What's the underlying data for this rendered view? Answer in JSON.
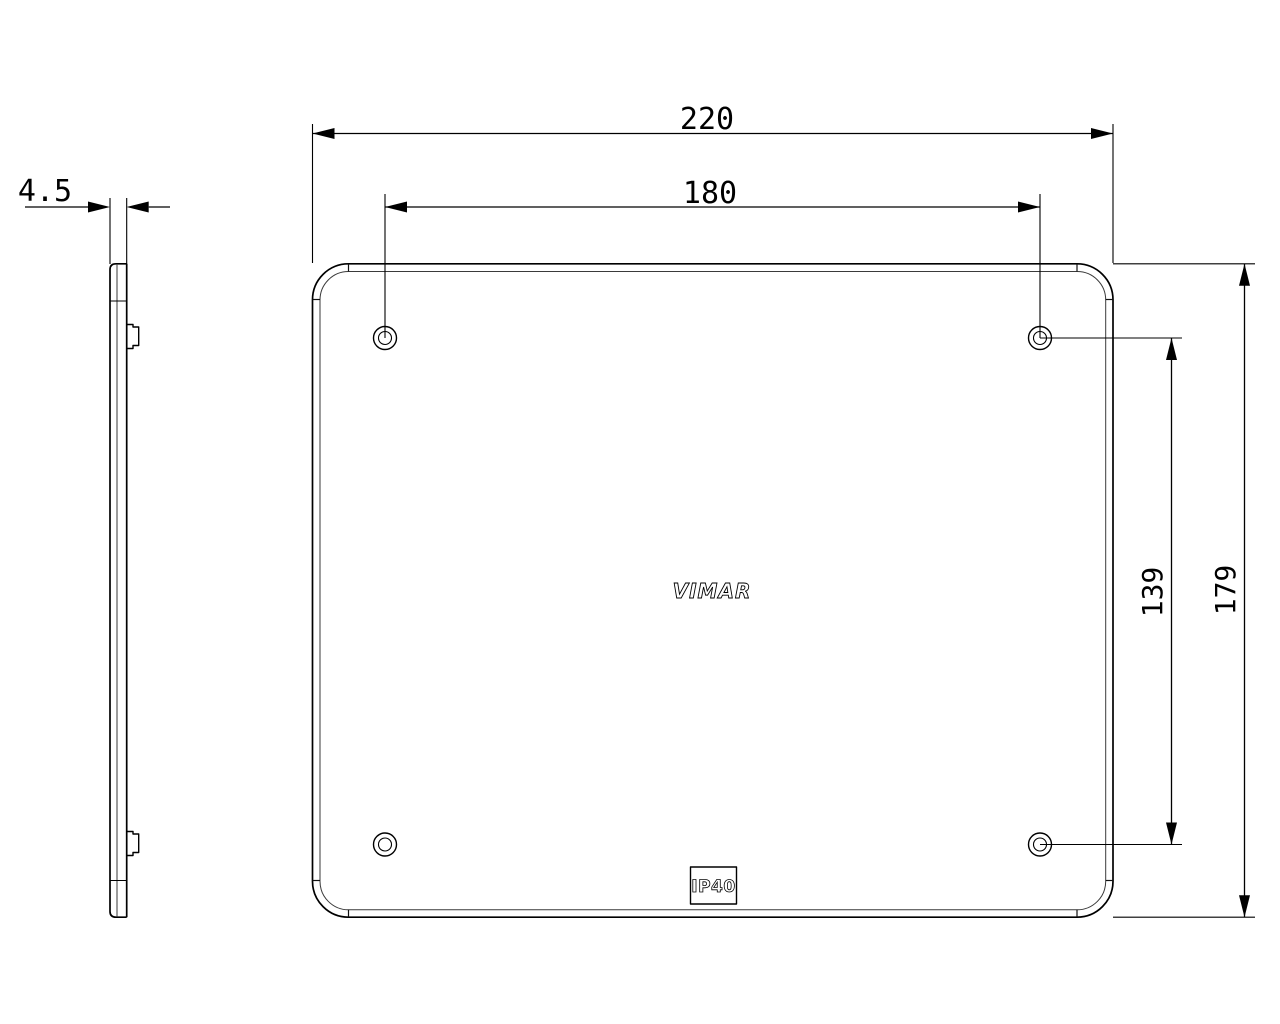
{
  "drawing": {
    "type": "technical-dimension-drawing",
    "views": [
      "side-profile",
      "front-face"
    ],
    "colors": {
      "line": "#000000",
      "inner_line": "#3a3a3a",
      "background": "#ffffff"
    }
  },
  "dimensions": {
    "overall_width": "220",
    "hole_spacing_horizontal": "180",
    "overall_height": "179",
    "hole_spacing_vertical": "139",
    "thickness": "4.5"
  },
  "plate": {
    "brand_label": "VIMAR",
    "ip_rating": "IP40",
    "screw_holes": 4
  }
}
